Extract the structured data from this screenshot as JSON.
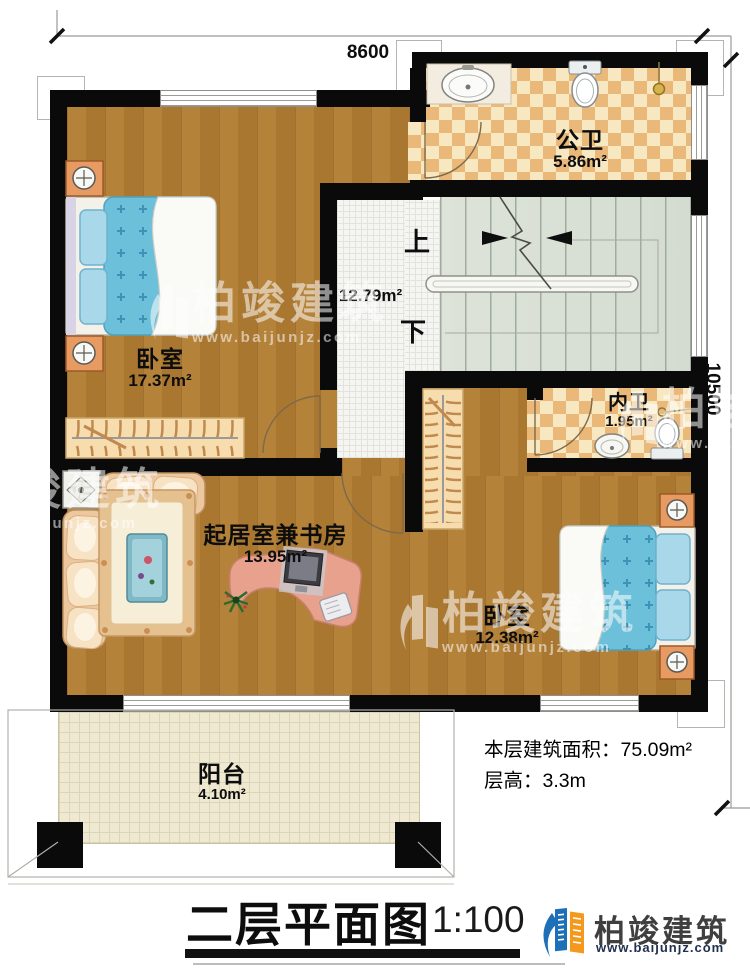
{
  "dimensions": {
    "width_label": "8600",
    "height_label": "10500"
  },
  "rooms": {
    "public_bath": {
      "name": "公卫",
      "area": "5.86m²"
    },
    "stair_hall": {
      "area": "12.79m²",
      "up_label": "上",
      "down_label": "下"
    },
    "bedroom1": {
      "name": "卧室",
      "area": "17.37m²"
    },
    "inner_bath": {
      "name": "内卫",
      "area": "1.95m²"
    },
    "living_study": {
      "name": "起居室兼书房",
      "area": "13.95m²"
    },
    "bedroom2": {
      "name": "卧室",
      "area": "12.38m²"
    },
    "balcony": {
      "name": "阳台",
      "area": "4.10m²"
    }
  },
  "notes": {
    "floor_area": "本层建筑面积：75.09m²",
    "floor_height": "层高：3.3m"
  },
  "footer": {
    "title": "二层平面图",
    "scale": "1:100"
  },
  "brand": {
    "name": "柏竣建筑",
    "url": "www.baijunjz.com"
  },
  "watermark": {
    "name": "柏竣建筑",
    "url": "www.baijunjz.com"
  },
  "colors": {
    "wall": "#0a0a0a",
    "wood": "#ad7b31",
    "tile_dark": "#eab878",
    "tile_light": "#f8e8c1",
    "stair_floor": "#d9dfd5",
    "bed_blue": "#6cc0da",
    "brand_blue": "#1d6fb8",
    "brand_orange": "#f5991e"
  }
}
